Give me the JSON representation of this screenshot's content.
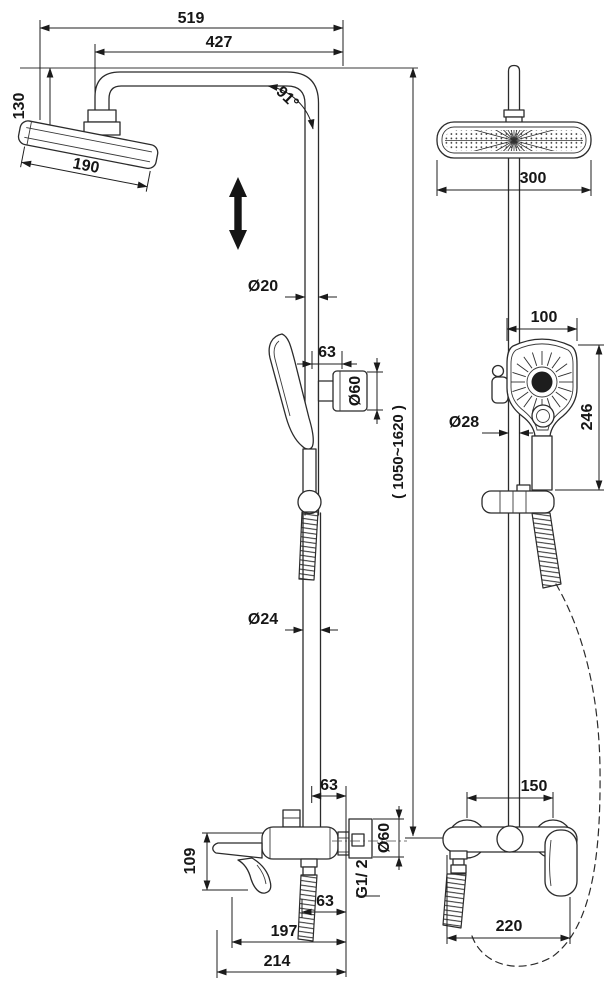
{
  "drawing": {
    "dimensions": {
      "total_width": "519",
      "arm_reach": "427",
      "head_drop": "130",
      "head_size_side": "190",
      "arm_angle": "91°",
      "riser_upper_dia": "Ø20",
      "holder_offset": "63",
      "holder_dia": "Ø60",
      "height_range": "( 1050~1620 )",
      "riser_lower_dia": "Ø24",
      "mixer_height": "109",
      "mixer_top_offset": "63",
      "wall_flange_dia": "Ø60",
      "thread_size": "G1/ 2",
      "mixer_bottom_offset": "63",
      "depth_to_spout": "197",
      "total_depth": "214",
      "head_width_front": "300",
      "hand_shower_width": "100",
      "hand_shower_length": "246",
      "slide_pipe_dia": "Ø28",
      "mixer_centers": "150",
      "mixer_width": "220"
    }
  },
  "colors": {
    "line": "#2b2b2b",
    "text": "#161616",
    "background": "#ffffff"
  }
}
